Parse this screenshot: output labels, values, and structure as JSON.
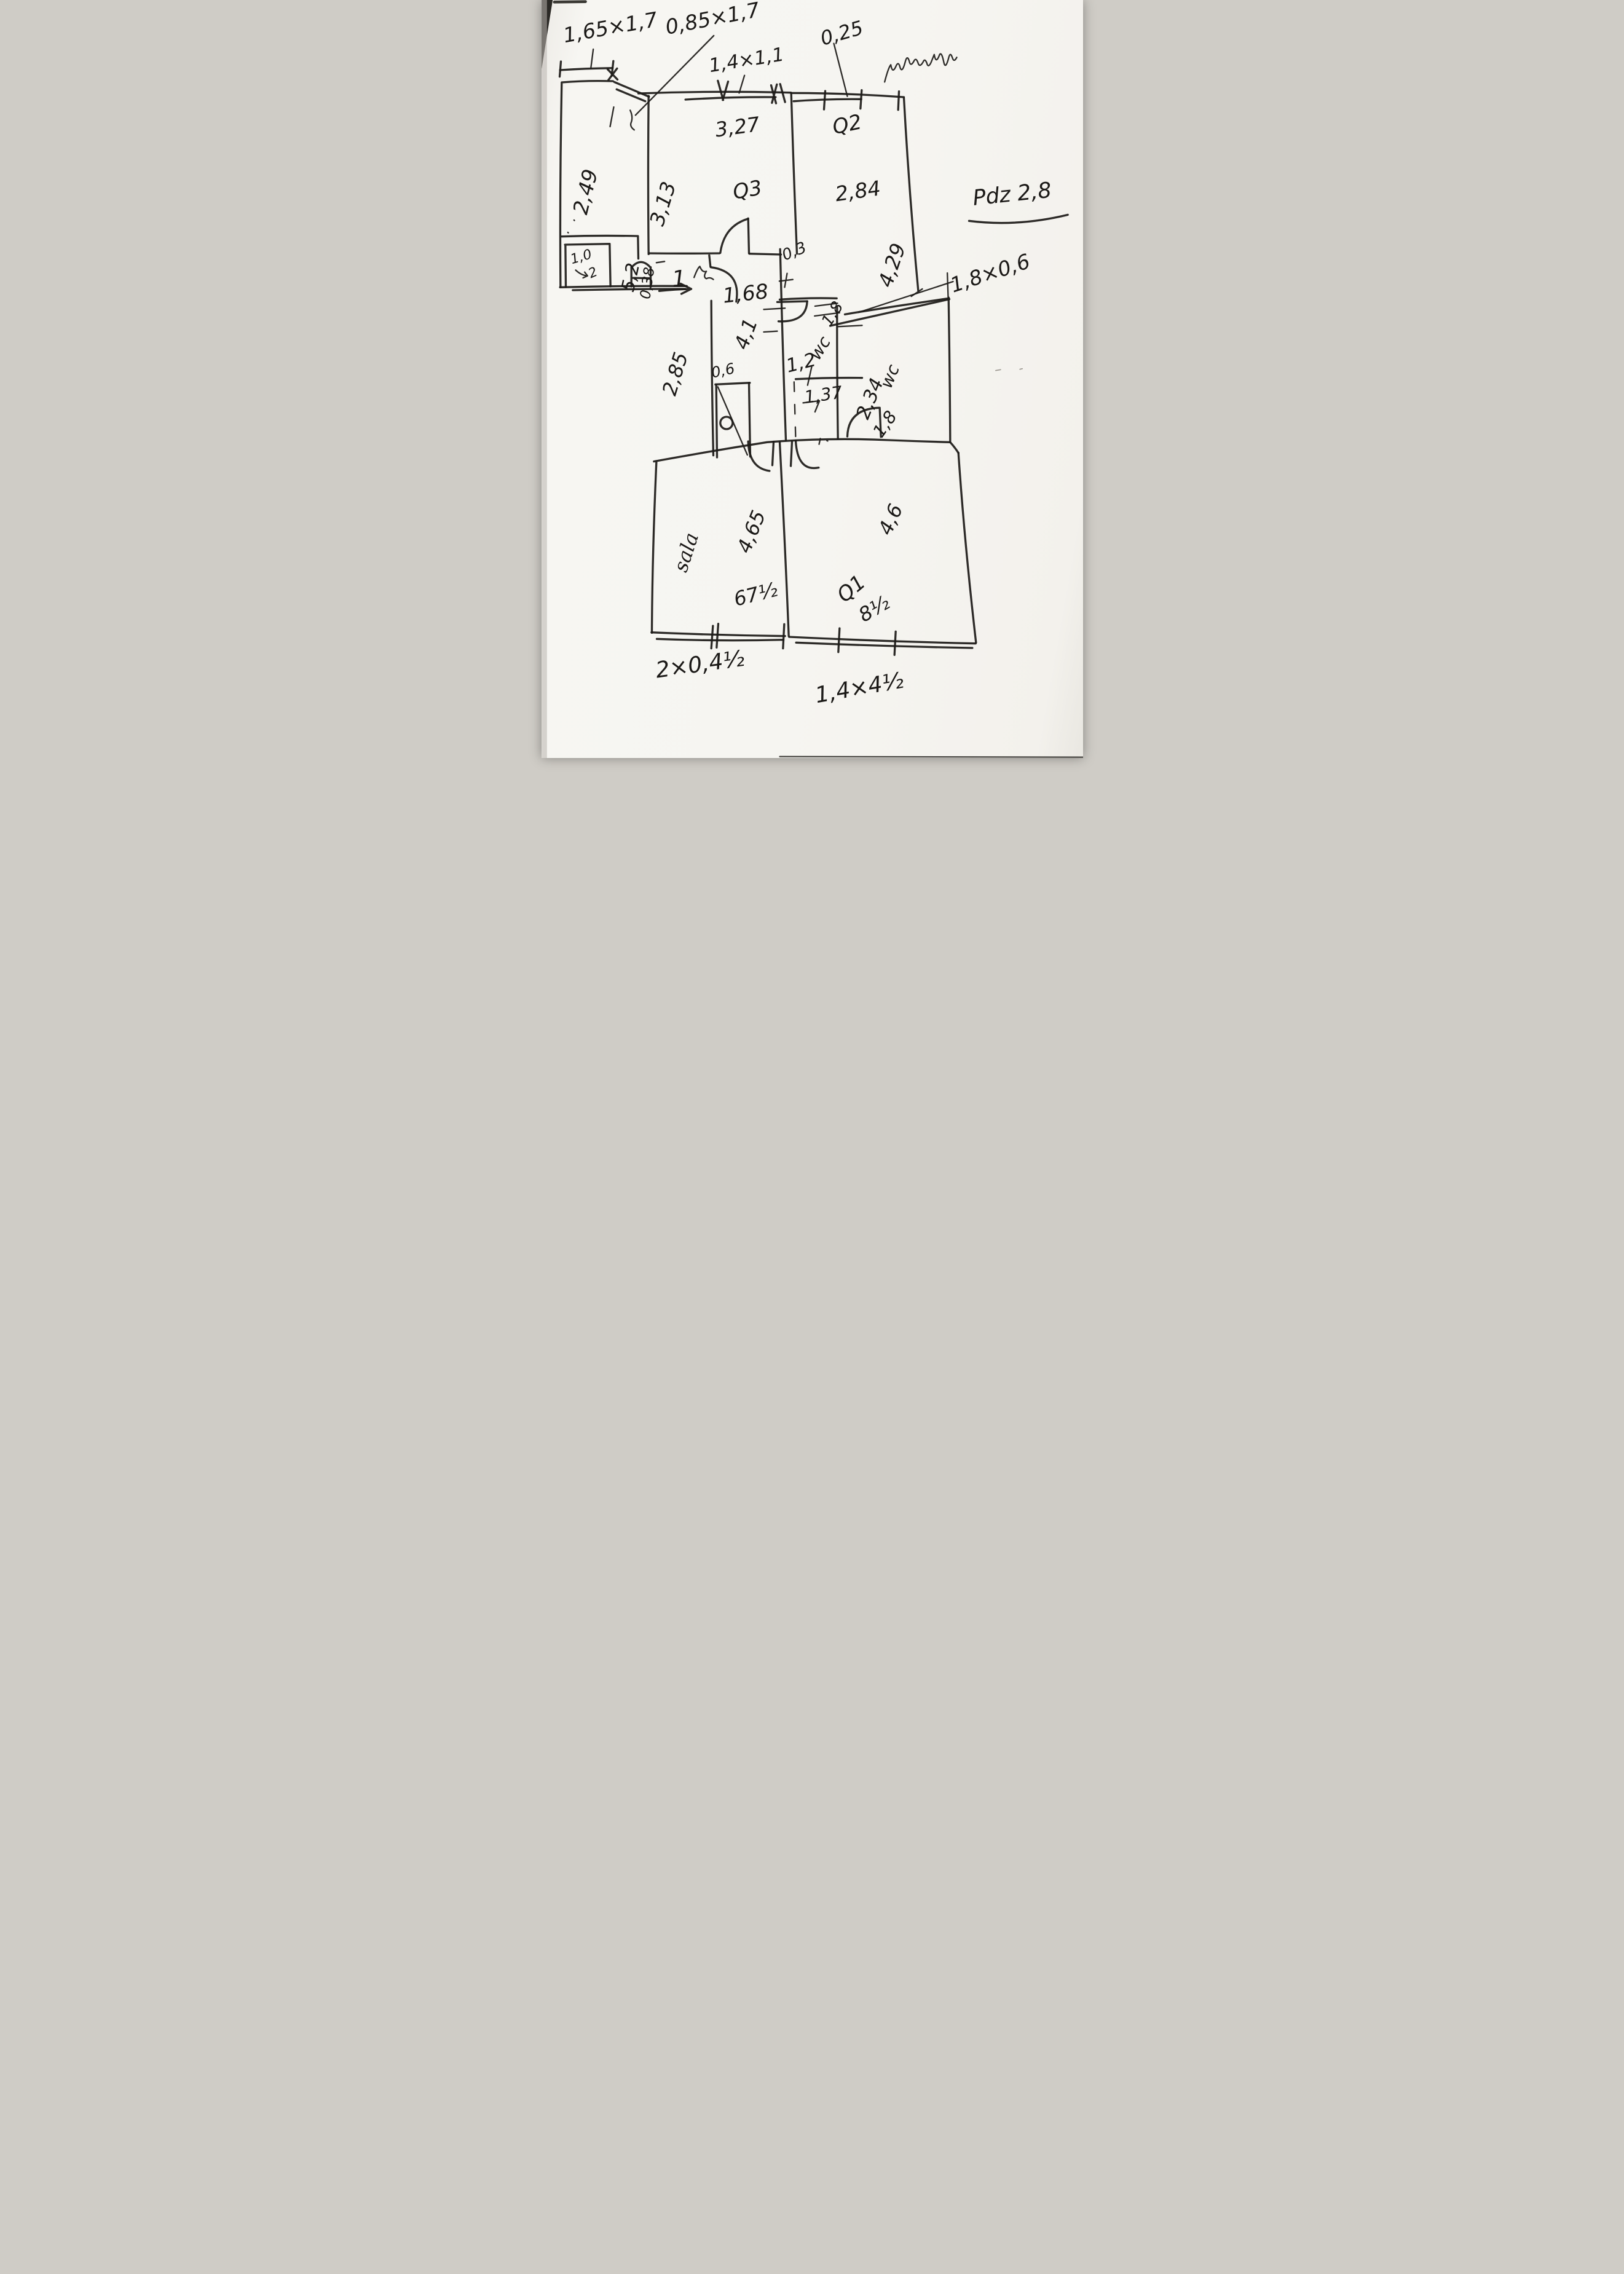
{
  "sketch": {
    "paper_color": "#f6f5f1",
    "ink_color": "#1d1b19",
    "top": {
      "window_a": "1,65×1,7",
      "window_b": "0,85×1,7",
      "window_c": "1,4×1,1",
      "wall_note": "0,25"
    },
    "side_note": "Pdz 2,8",
    "left_room": {
      "width": "2,49",
      "depth": "5,2",
      "nook_w": "1,0",
      "nook_d": "2",
      "jamb": "0,38",
      "door": "1"
    },
    "room_q3": {
      "label": "Q3",
      "width": "3,27",
      "depth": "3,13"
    },
    "room_q2": {
      "label": "Q2",
      "width": "2,84",
      "depth": "4,29"
    },
    "hall": {
      "width": "1,68",
      "length": "4,1",
      "side": "2,85",
      "gap": "0,3",
      "recess": "0,6"
    },
    "wc_a": {
      "label": "wc",
      "width": "1,2",
      "depth": "1,8",
      "inner": "1,37"
    },
    "wc_b": {
      "label": "wc",
      "depth": "2,34",
      "width": "1,8",
      "niche": "1,8×0,6"
    },
    "sala": {
      "label": "sala",
      "width": "4,65",
      "note": "67½",
      "window": "2×0,4½"
    },
    "room_q1": {
      "label": "Q1",
      "depth": "4,6",
      "note": "8½",
      "window": "1,4×4½"
    }
  }
}
